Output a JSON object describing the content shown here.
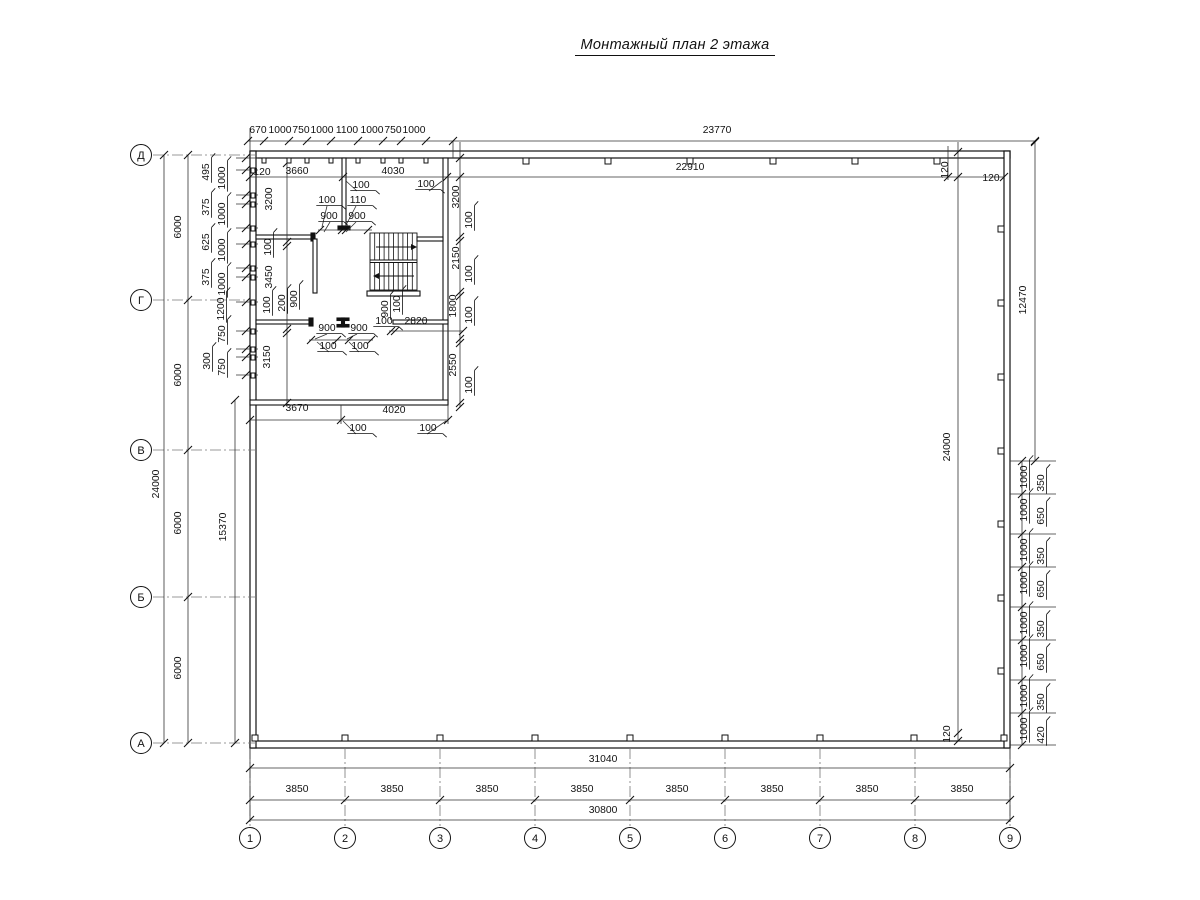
{
  "title": "Монтажный план 2 этажа",
  "drawing_type": "installation plan, floor 2",
  "axes": {
    "rows": [
      {
        "label": "Д",
        "y": 155
      },
      {
        "label": "Г",
        "y": 300
      },
      {
        "label": "В",
        "y": 450
      },
      {
        "label": "Б",
        "y": 597
      },
      {
        "label": "А",
        "y": 743
      }
    ],
    "cols": [
      {
        "label": "1",
        "x": 250
      },
      {
        "label": "2",
        "x": 345
      },
      {
        "label": "3",
        "x": 440
      },
      {
        "label": "4",
        "x": 535
      },
      {
        "label": "5",
        "x": 630
      },
      {
        "label": "6",
        "x": 725
      },
      {
        "label": "7",
        "x": 820
      },
      {
        "label": "8",
        "x": 915
      },
      {
        "label": "9",
        "x": 1010
      }
    ]
  },
  "overall_dimensions": {
    "top_outer": "23770",
    "top_inner": "22910",
    "bottom_outer": "31040",
    "bottom_grid_total": "30800",
    "left_total": "24000",
    "right_total": "24000",
    "right_upper": "12470",
    "left_lower_inner": "15370",
    "grid_bay": "3850",
    "axis_step": "6000"
  },
  "annotations": [
    {
      "t": "670",
      "x": 258,
      "y": 133
    },
    {
      "t": "1000",
      "x": 280,
      "y": 133
    },
    {
      "t": "750",
      "x": 301,
      "y": 133
    },
    {
      "t": "1000",
      "x": 322,
      "y": 133
    },
    {
      "t": "1100",
      "x": 347,
      "y": 133
    },
    {
      "t": "1000",
      "x": 372,
      "y": 133
    },
    {
      "t": "750",
      "x": 393,
      "y": 133
    },
    {
      "t": "1000",
      "x": 414,
      "y": 133
    },
    {
      "t": "23770",
      "x": 717,
      "y": 133
    },
    {
      "t": "22910",
      "x": 690,
      "y": 170
    },
    {
      "t": "120",
      "x": 948,
      "y": 170,
      "r": 1
    },
    {
      "t": "120",
      "x": 991,
      "y": 181
    },
    {
      "t": "120",
      "x": 262,
      "y": 175
    },
    {
      "t": "3660",
      "x": 297,
      "y": 174
    },
    {
      "t": "4030",
      "x": 393,
      "y": 174
    },
    {
      "t": "100",
      "x": 361,
      "y": 188,
      "u": 1
    },
    {
      "t": "100",
      "x": 426,
      "y": 187,
      "u": 1
    },
    {
      "t": "100",
      "x": 327,
      "y": 203,
      "u": 1
    },
    {
      "t": "110",
      "x": 358,
      "y": 203,
      "u": 1
    },
    {
      "t": "900",
      "x": 329,
      "y": 219,
      "u": 1
    },
    {
      "t": "900",
      "x": 357,
      "y": 219,
      "u": 1
    },
    {
      "t": "3200",
      "x": 272,
      "y": 199,
      "r": 1
    },
    {
      "t": "100",
      "x": 271,
      "y": 247,
      "r": 1,
      "u": 1
    },
    {
      "t": "3450",
      "x": 272,
      "y": 277,
      "r": 1
    },
    {
      "t": "100",
      "x": 270,
      "y": 305,
      "r": 1,
      "u": 1
    },
    {
      "t": "200",
      "x": 285,
      "y": 303,
      "r": 1,
      "u": 1
    },
    {
      "t": "900",
      "x": 297,
      "y": 299,
      "r": 1,
      "u": 1
    },
    {
      "t": "3150",
      "x": 270,
      "y": 357,
      "r": 1
    },
    {
      "t": "900",
      "x": 327,
      "y": 331,
      "u": 1
    },
    {
      "t": "900",
      "x": 359,
      "y": 331,
      "u": 1
    },
    {
      "t": "100",
      "x": 328,
      "y": 349,
      "u": 1
    },
    {
      "t": "100",
      "x": 360,
      "y": 349,
      "u": 1
    },
    {
      "t": "900",
      "x": 388,
      "y": 309,
      "r": 1,
      "u": 1
    },
    {
      "t": "100",
      "x": 400,
      "y": 304,
      "r": 1,
      "u": 1
    },
    {
      "t": "100",
      "x": 384,
      "y": 324,
      "u": 1
    },
    {
      "t": "2820",
      "x": 416,
      "y": 324
    },
    {
      "t": "3200",
      "x": 459,
      "y": 197,
      "r": 1
    },
    {
      "t": "100",
      "x": 472,
      "y": 220,
      "r": 1,
      "u": 1
    },
    {
      "t": "2150",
      "x": 459,
      "y": 258,
      "r": 1
    },
    {
      "t": "100",
      "x": 472,
      "y": 274,
      "r": 1,
      "u": 1
    },
    {
      "t": "1800",
      "x": 456,
      "y": 306,
      "r": 1
    },
    {
      "t": "100",
      "x": 472,
      "y": 315,
      "r": 1,
      "u": 1
    },
    {
      "t": "2550",
      "x": 456,
      "y": 365,
      "r": 1
    },
    {
      "t": "100",
      "x": 472,
      "y": 385,
      "r": 1,
      "u": 1
    },
    {
      "t": "3670",
      "x": 297,
      "y": 411
    },
    {
      "t": "4020",
      "x": 394,
      "y": 413
    },
    {
      "t": "100",
      "x": 358,
      "y": 431,
      "u": 1
    },
    {
      "t": "100",
      "x": 428,
      "y": 431,
      "u": 1
    },
    {
      "t": "24000",
      "x": 159,
      "y": 484,
      "r": 1
    },
    {
      "t": "6000",
      "x": 181,
      "y": 227,
      "r": 1
    },
    {
      "t": "6000",
      "x": 181,
      "y": 375,
      "r": 1
    },
    {
      "t": "6000",
      "x": 181,
      "y": 523,
      "r": 1
    },
    {
      "t": "6000",
      "x": 181,
      "y": 668,
      "r": 1
    },
    {
      "t": "15370",
      "x": 226,
      "y": 527,
      "r": 1
    },
    {
      "t": "495",
      "x": 209,
      "y": 172,
      "r": 1,
      "u": 1
    },
    {
      "t": "375",
      "x": 209,
      "y": 207,
      "r": 1,
      "u": 1
    },
    {
      "t": "625",
      "x": 209,
      "y": 242,
      "r": 1,
      "u": 1
    },
    {
      "t": "375",
      "x": 209,
      "y": 277,
      "r": 1,
      "u": 1
    },
    {
      "t": "300",
      "x": 210,
      "y": 361,
      "r": 1,
      "u": 1
    },
    {
      "t": "1000",
      "x": 225,
      "y": 178,
      "r": 1,
      "u": 1
    },
    {
      "t": "1000",
      "x": 225,
      "y": 214,
      "r": 1,
      "u": 1
    },
    {
      "t": "1000",
      "x": 225,
      "y": 250,
      "r": 1,
      "u": 1
    },
    {
      "t": "1000",
      "x": 225,
      "y": 284,
      "r": 1,
      "u": 1
    },
    {
      "t": "1200",
      "x": 224,
      "y": 309,
      "r": 1,
      "u": 1
    },
    {
      "t": "750",
      "x": 225,
      "y": 334,
      "r": 1,
      "u": 1
    },
    {
      "t": "750",
      "x": 225,
      "y": 367,
      "r": 1,
      "u": 1
    },
    {
      "t": "24000",
      "x": 950,
      "y": 447,
      "r": 1
    },
    {
      "t": "12470",
      "x": 1026,
      "y": 300,
      "r": 1
    },
    {
      "t": "120",
      "x": 950,
      "y": 734,
      "r": 1
    },
    {
      "t": "1000",
      "x": 1027,
      "y": 477,
      "r": 1,
      "u": 1
    },
    {
      "t": "350",
      "x": 1044,
      "y": 483,
      "r": 1,
      "u": 1
    },
    {
      "t": "1000",
      "x": 1027,
      "y": 510,
      "r": 1,
      "u": 1
    },
    {
      "t": "650",
      "x": 1044,
      "y": 516,
      "r": 1,
      "u": 1
    },
    {
      "t": "1000",
      "x": 1027,
      "y": 550,
      "r": 1,
      "u": 1
    },
    {
      "t": "350",
      "x": 1044,
      "y": 556,
      "r": 1,
      "u": 1
    },
    {
      "t": "1000",
      "x": 1027,
      "y": 583,
      "r": 1,
      "u": 1
    },
    {
      "t": "650",
      "x": 1044,
      "y": 589,
      "r": 1,
      "u": 1
    },
    {
      "t": "1000",
      "x": 1027,
      "y": 623,
      "r": 1,
      "u": 1
    },
    {
      "t": "350",
      "x": 1044,
      "y": 629,
      "r": 1,
      "u": 1
    },
    {
      "t": "1000",
      "x": 1027,
      "y": 656,
      "r": 1,
      "u": 1
    },
    {
      "t": "650",
      "x": 1044,
      "y": 662,
      "r": 1,
      "u": 1
    },
    {
      "t": "1000",
      "x": 1027,
      "y": 696,
      "r": 1,
      "u": 1
    },
    {
      "t": "350",
      "x": 1044,
      "y": 702,
      "r": 1,
      "u": 1
    },
    {
      "t": "1000",
      "x": 1027,
      "y": 729,
      "r": 1,
      "u": 1
    },
    {
      "t": "420",
      "x": 1044,
      "y": 735,
      "r": 1,
      "u": 1
    },
    {
      "t": "31040",
      "x": 603,
      "y": 762
    },
    {
      "t": "3850",
      "x": 297,
      "y": 792
    },
    {
      "t": "3850",
      "x": 392,
      "y": 792
    },
    {
      "t": "3850",
      "x": 487,
      "y": 792
    },
    {
      "t": "3850",
      "x": 582,
      "y": 792
    },
    {
      "t": "3850",
      "x": 677,
      "y": 792
    },
    {
      "t": "3850",
      "x": 772,
      "y": 792
    },
    {
      "t": "3850",
      "x": 867,
      "y": 792
    },
    {
      "t": "3850",
      "x": 962,
      "y": 792
    },
    {
      "t": "30800",
      "x": 603,
      "y": 813
    }
  ]
}
